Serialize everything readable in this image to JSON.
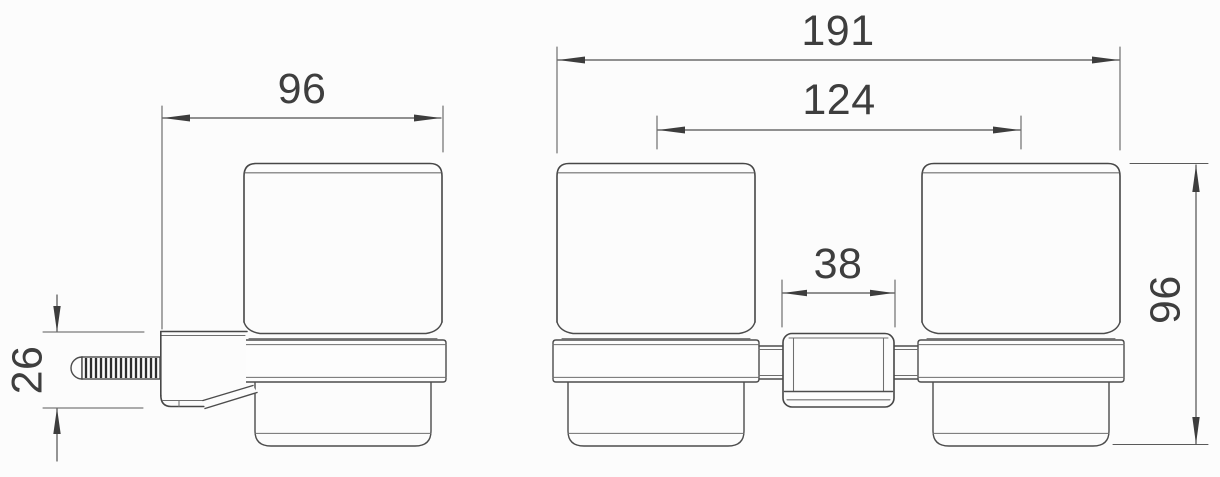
{
  "drawing": {
    "colors": {
      "background": "#fcfcfc",
      "line": "#474747",
      "dimension_text": "#3e3e3e"
    },
    "side_view": {
      "dim_width": "96",
      "dim_bracket_height": "26"
    },
    "front_view": {
      "dim_overall_width": "191",
      "dim_center_spacing": "124",
      "dim_bracket_width": "38",
      "dim_height": "96"
    }
  }
}
